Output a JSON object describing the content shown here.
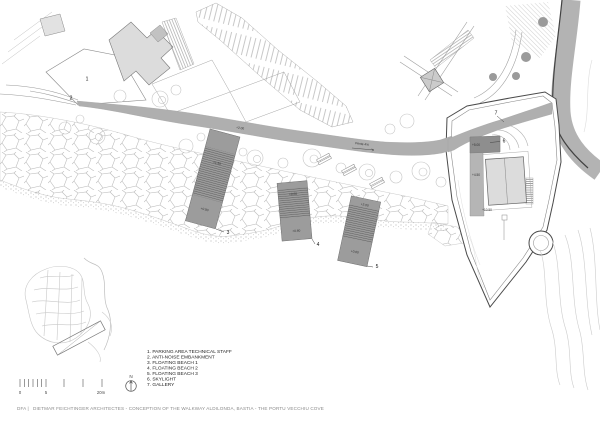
{
  "document": {
    "caption_prefix": "DFA |",
    "caption": "DIETMAR FEICHTINGER ARCHITECTES - CONCEPTION OF THE WALKWAY ALDILONDA, BASTIA - THE PORTU VECCHIU COVE"
  },
  "legend": {
    "items": [
      "1. PARKING AREA TECHNICAL STAFF",
      "2. ANTI-NOISE EMBANKMENT",
      "3. FLOATING BEACH 1",
      "4. FLOATING BEACH 2",
      "5. FLOATING BEACH 3",
      "6. SKYLIGHT",
      "7. GALLERY"
    ]
  },
  "scale_bar": {
    "start": "0",
    "mid": "5",
    "end": "20m"
  },
  "north_arrow": {
    "label": "N"
  },
  "plan": {
    "markers": {
      "m1": "1",
      "m2": "2",
      "m3": "3",
      "m4": "4",
      "m5": "5",
      "m6": "6",
      "m7": "7"
    },
    "annotations": {
      "walkway_level": "+2.00",
      "beach1_ramp": "+1.50",
      "beach1_platform": "+0.90",
      "beach2_top": "+0.60",
      "beach2_platform": "+0.60",
      "beach3_top": "+2.00",
      "beach3_platform": "+0.60",
      "skylight_level": "+5.00",
      "gallery_level": "+4.50",
      "fort_court_level": "+10.50",
      "slope_note": "Pente 4%"
    }
  },
  "colors": {
    "walkway": "#afafaf",
    "beach": "#9c9c9c",
    "building": "#dcdcdc",
    "skylight": "#8e8e8e",
    "road": "#b3b3b3",
    "tree_dot": "#9a9a9a",
    "paper": "#ffffff"
  }
}
